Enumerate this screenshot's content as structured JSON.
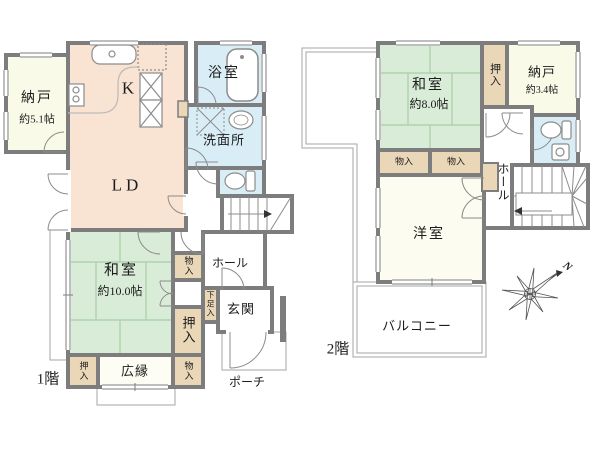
{
  "floors": {
    "f1": {
      "label": "1階",
      "rooms": {
        "nando": {
          "name": "納戸",
          "size": "約5.1帖"
        },
        "kitchen": {
          "name": "K"
        },
        "ld": {
          "name": "LD"
        },
        "bath": {
          "name": "浴室"
        },
        "washroom": {
          "name": "洗面所"
        },
        "washitsu": {
          "name": "和室",
          "size": "約10.0帖"
        },
        "monoiri_upper": {
          "name": "物入"
        },
        "oshiire_right": {
          "name": "押入"
        },
        "oshiire_left": {
          "name": "押入"
        },
        "hiroen": {
          "name": "広縁"
        },
        "monoiri_lower": {
          "name": "物入"
        },
        "hall": {
          "name": "ホール"
        },
        "shoe": {
          "name": "下足入"
        },
        "genkan": {
          "name": "玄関"
        },
        "porch": {
          "name": "ポーチ"
        }
      }
    },
    "f2": {
      "label": "2階",
      "rooms": {
        "washitsu": {
          "name": "和室",
          "size": "約8.0帖"
        },
        "oshiire": {
          "name": "押入"
        },
        "nando": {
          "name": "納戸",
          "size": "約3.4帖"
        },
        "monoiri_a": {
          "name": "物入"
        },
        "monoiri_b": {
          "name": "物入"
        },
        "yoshitsu": {
          "name": "洋室"
        },
        "hall": {
          "name": "ホール"
        },
        "balcony": {
          "name": "バルコニー"
        }
      }
    }
  },
  "compass": {
    "label": "N"
  },
  "colors": {
    "wall": "#7d7d7d",
    "tatami_green": "#d9ecd7",
    "closet_tan": "#ead7b8",
    "water_blue": "#d9edf6",
    "ld_peach": "#f9e3d3",
    "cream": "#fafae8"
  }
}
